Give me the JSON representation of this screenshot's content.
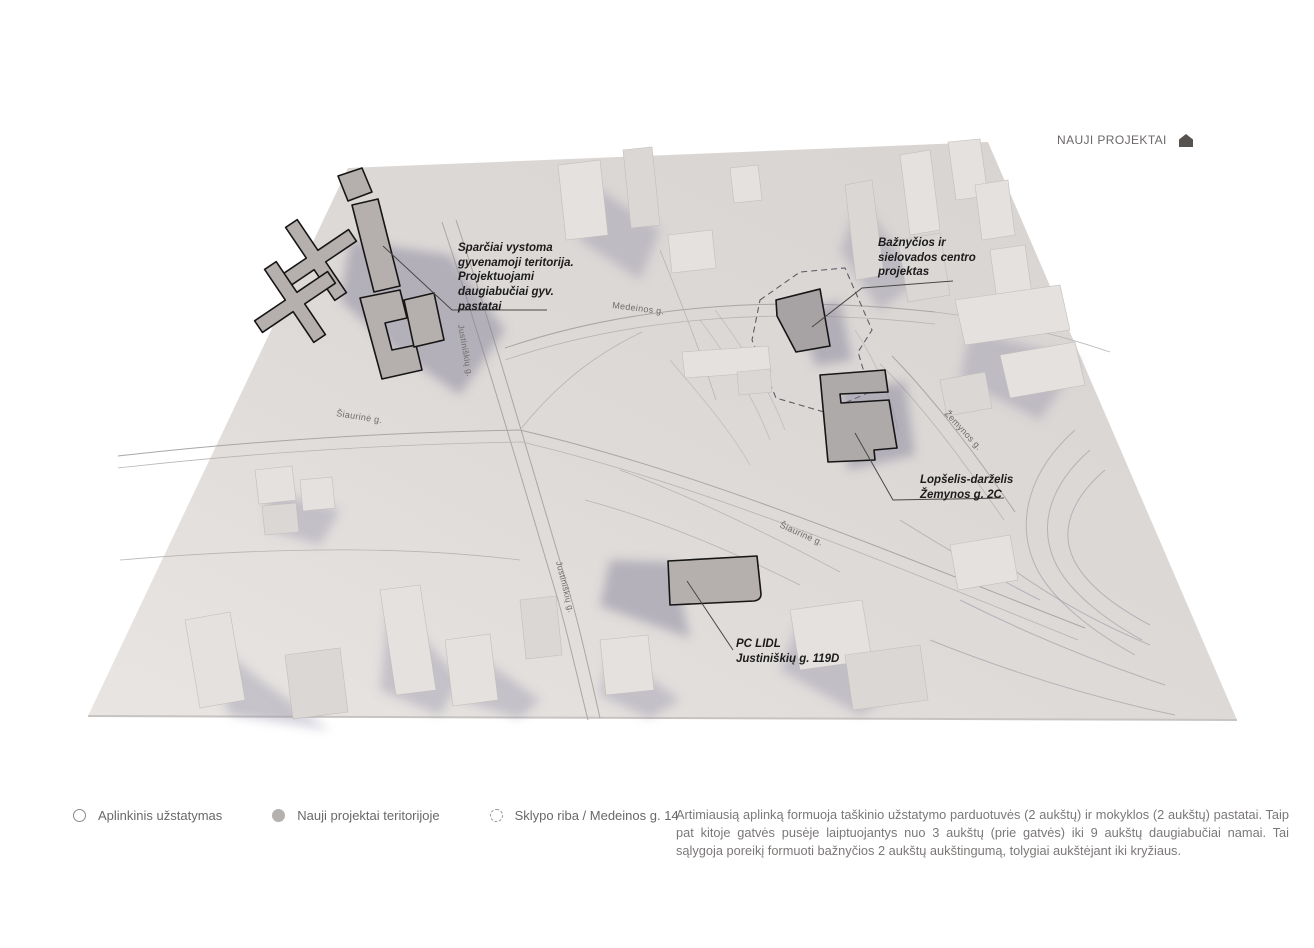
{
  "header": {
    "title": "NAUJI PROJEKTAI",
    "icon": "house-icon",
    "color": "#6b6867"
  },
  "map": {
    "annotations": [
      {
        "id": "residential-territory",
        "text": "Sparčiai vystoma\ngyvenamoji teritorija.\nProjektuojami\ndaugiabučiai gyv.\npastatai"
      },
      {
        "id": "church-project",
        "text": "Bažnyčios ir\nsielovados centro\nprojektas"
      },
      {
        "id": "kindergarten",
        "text": "Lopšelis-darželis\nŽemynos g. 2C"
      },
      {
        "id": "lidl-store",
        "text": "PC LIDL\nJustiniškių g. 119D"
      }
    ],
    "street_labels": [
      {
        "text": "Medeinos g."
      },
      {
        "text": "Šiaurinė g."
      },
      {
        "text": "Šiaurinė g."
      },
      {
        "text": "Žemynos g."
      },
      {
        "text": "Justiniškių g."
      },
      {
        "text": "Justiniškių g."
      }
    ],
    "colors": {
      "terrain_light": "#e8e5e3",
      "terrain_dark": "#d7d3d1",
      "shadow": "#8a87a0",
      "new_project_fill": "#b5b0ae",
      "new_project_outline": "#161616",
      "contour": "#8e8b9b"
    }
  },
  "legend": {
    "items": [
      {
        "icon": "outline-circle",
        "label": "Aplinkinis užstatymas"
      },
      {
        "icon": "filled-circle",
        "label": "Nauji projektai teritorijoje"
      },
      {
        "icon": "dashed-circle",
        "label": "Sklypo riba / Medeinos g. 14"
      }
    ]
  },
  "description": {
    "text": "Artimiausią aplinką formuoja taškinio užstatymo parduotuvės (2 aukštų) ir mokyklos (2 aukštų) pastatai. Taip pat kitoje gatvės pusėje laiptuojantys nuo 3 aukštų (prie gatvės) iki 9 aukštų daugiabučiai namai. Tai sąlygoja poreikį formuoti bažnyčios 2 aukštų aukštingumą, tolygiai aukštėjant iki kryžiaus."
  }
}
